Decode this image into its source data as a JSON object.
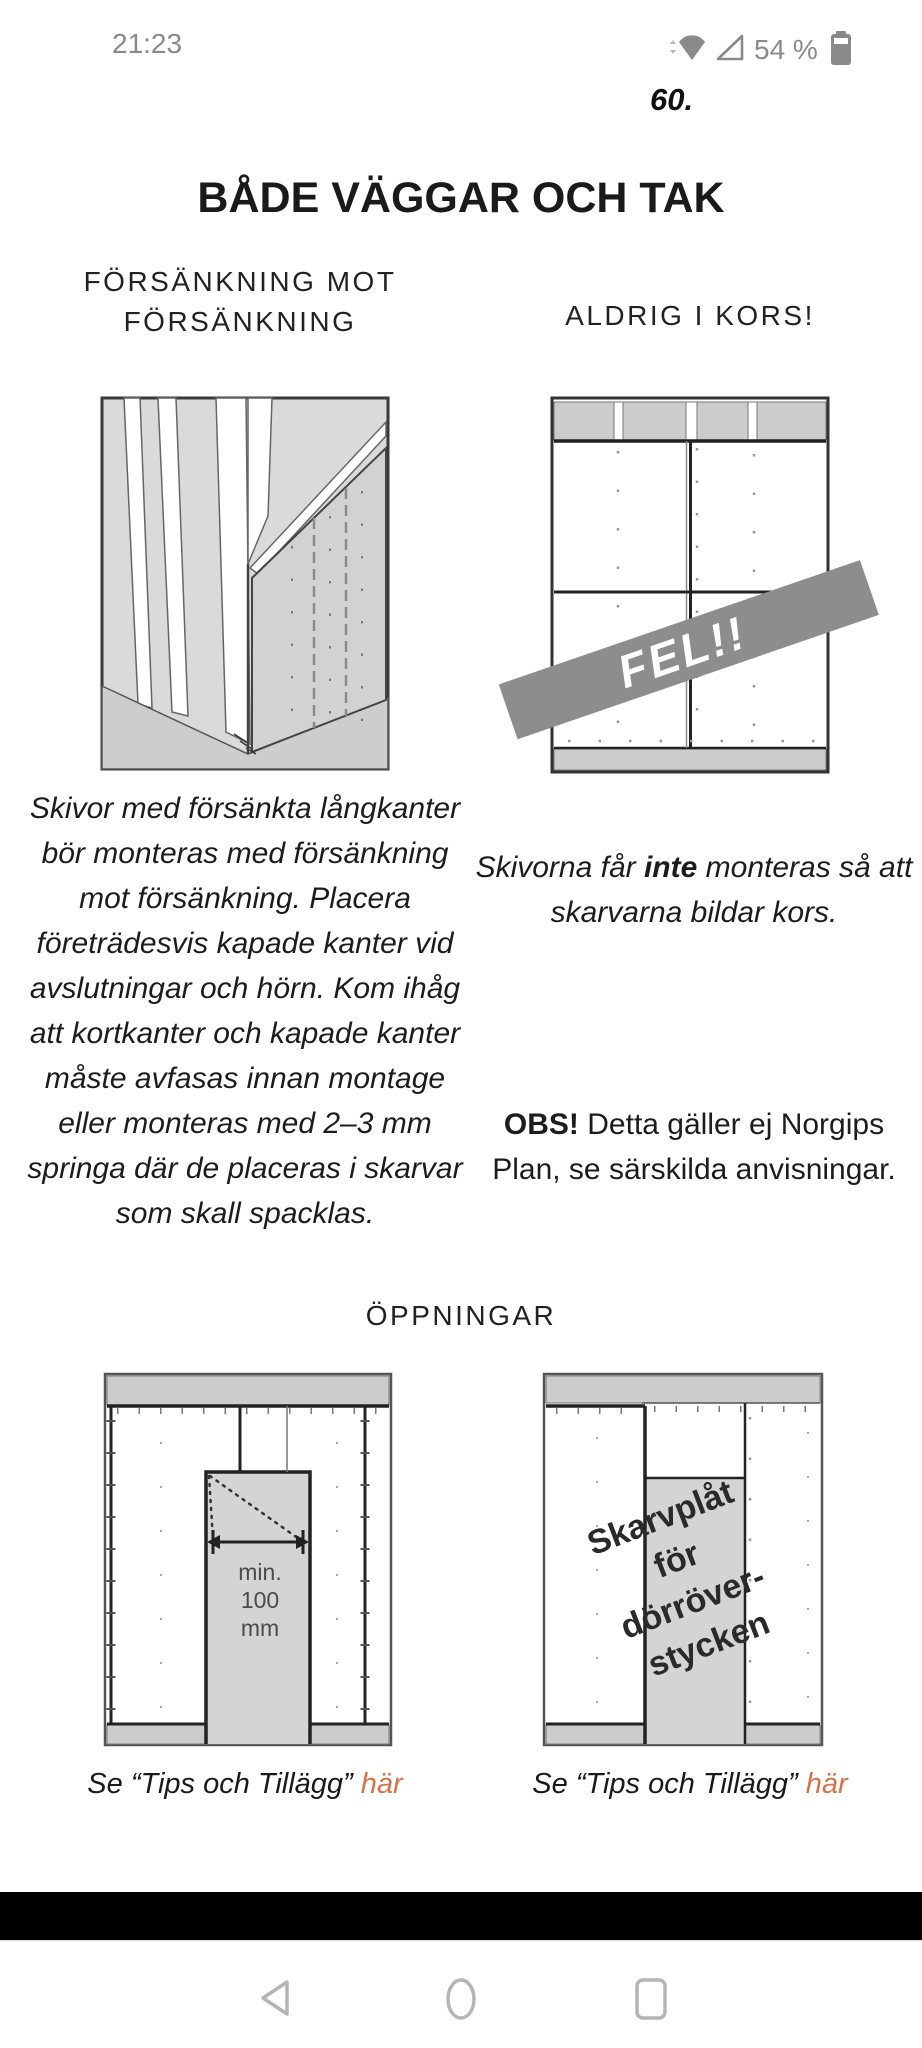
{
  "status": {
    "time": "21:23",
    "battery": "54 %"
  },
  "page": {
    "number": "60.",
    "title": "BÅDE VÄGGAR OCH TAK"
  },
  "left_section": {
    "heading": "FÖRSÄNKNING MOT FÖRSÄNKNING",
    "body": "Skivor med försänkta långkanter bör monteras med försänkning mot försänkning. Placera företrädesvis kapade kanter vid avslutningar och hörn. Kom ihåg att kortkanter och kapade kanter måste avfasas innan montage eller monteras med 2–3 mm springa där de placeras i skarvar som skall spacklas."
  },
  "right_section": {
    "heading": "ALDRIG I KORS!",
    "body_prefix": "Skivorna får ",
    "body_bold": "inte",
    "body_suffix": " monteras så att skarvarna bildar kors.",
    "note_bold": "OBS!",
    "note_rest": " Detta gäller ej Norgips Plan, se särskilda anvisningar.",
    "banner": "FEL!!"
  },
  "openings": {
    "heading": "ÖPPNINGAR",
    "captions": [
      {
        "text": "Se “Tips och Tillägg” ",
        "link": "här"
      },
      {
        "text": "Se “Tips och Tillägg” ",
        "link": "här"
      }
    ],
    "dim_label": [
      "min.",
      "100",
      "mm"
    ],
    "plate_label": [
      "Skarvplåt",
      "för",
      "dörröver-",
      "stycken"
    ]
  },
  "colors": {
    "accent_link": "#d9714a",
    "banner_gray": "#8d8d8d",
    "fill_gray": "#cfcfcf",
    "status_gray": "#8a8a8a",
    "nav_gray": "#b5b5b5"
  }
}
